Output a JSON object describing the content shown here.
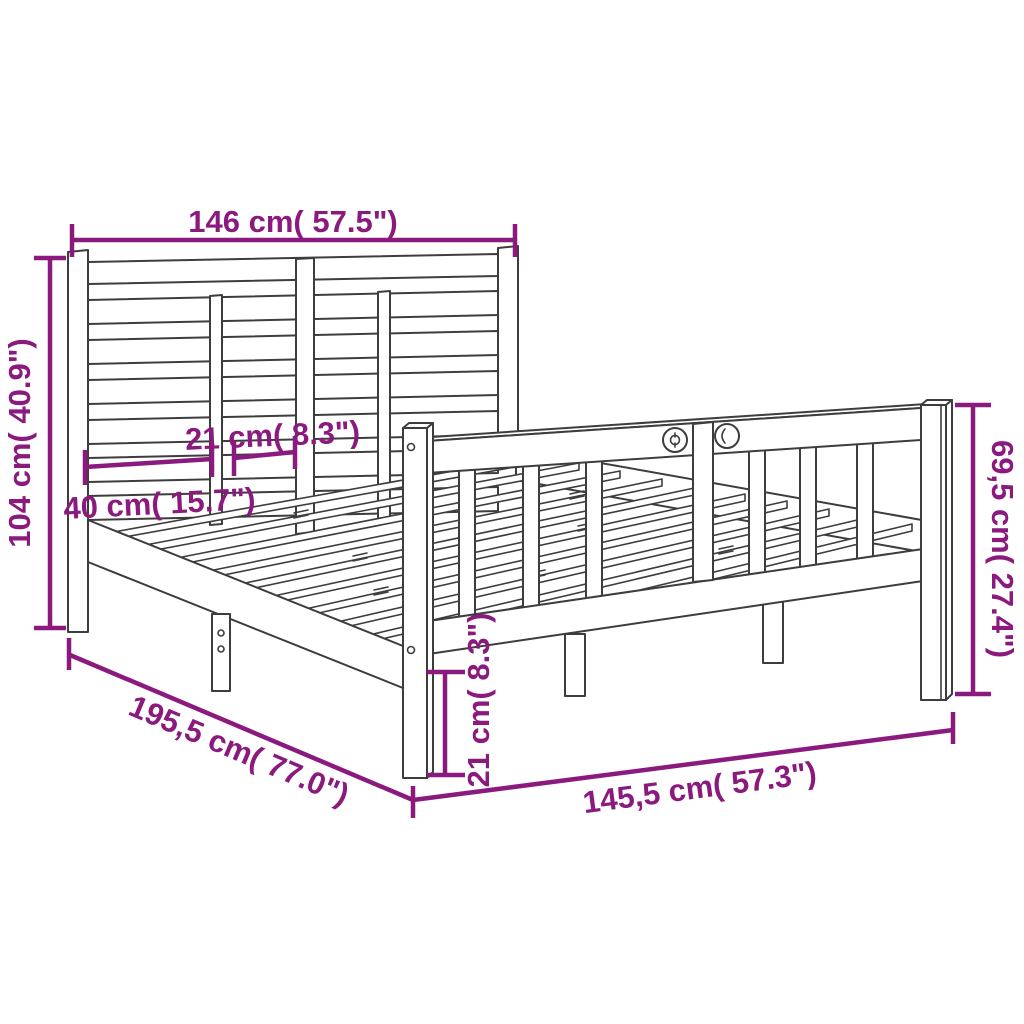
{
  "diagram": {
    "subject": "bed-frame-dimension-diagram"
  },
  "colors": {
    "dimension": "#8a1a7d",
    "line": "#3d3d3d",
    "background": "#ffffff"
  },
  "dimensions": {
    "headboard_width": "146 cm( 57.5\")",
    "headboard_height": "104 cm( 40.9\")",
    "headboard_slat_spacing": "21 cm( 8.3\")",
    "headboard_section_width": "40 cm( 15.7\")",
    "footboard_height": "69,5 cm( 27.4\")",
    "frame_length": "195,5 cm( 77.0\")",
    "frame_width": "145,5 cm( 57.3\")",
    "leg_height": "21 cm( 8.3\")"
  }
}
